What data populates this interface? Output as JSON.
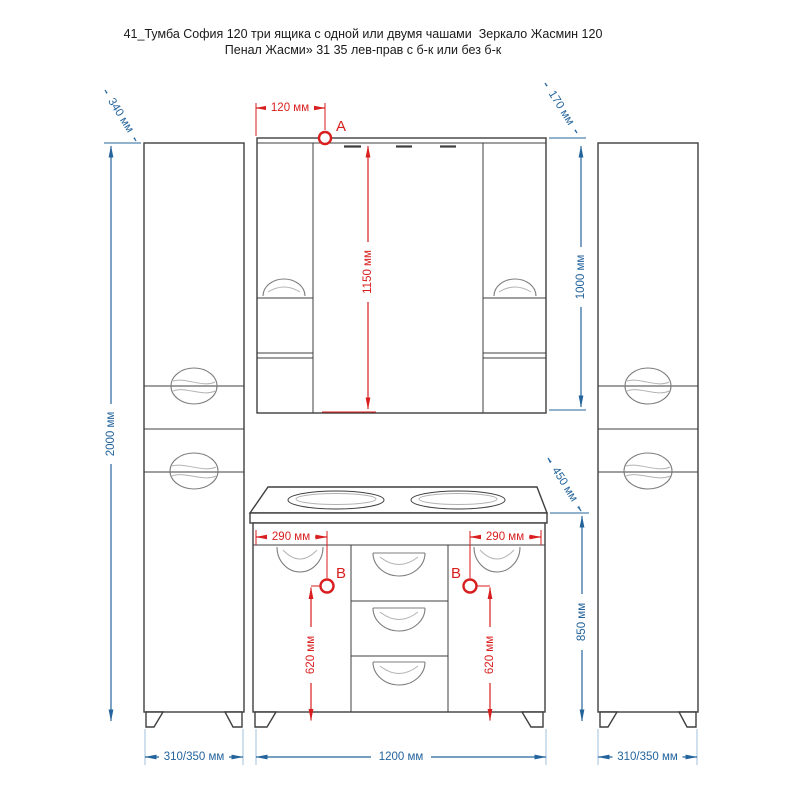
{
  "title": {
    "line1": "41_Тумба София 120 три ящика с одной или двумя чашами  Зеркало Жасмин 120",
    "line2": "Пенал Жасми» 31 35 лев-прав с б-к или без б-к"
  },
  "dimensions": {
    "cabinet_depth": "340 мм",
    "cabinet_height": "2000 мм",
    "point_a_offset": "120 мм",
    "mirror_shelf_depth": "170 мм",
    "mirror_mount_span": "1150 мм",
    "mirror_height": "1000 мм",
    "countertop_depth": "450 мм",
    "vanity_height": "850 мм",
    "left_sink_offset": "290 мм",
    "right_sink_offset": "290 мм",
    "left_point_b_height": "620 мм",
    "right_point_b_height": "620 мм",
    "left_cabinet_width": "310/350 мм",
    "vanity_width": "1200 мм",
    "right_cabinet_width": "310/350 мм"
  },
  "markers": {
    "point_a": "A",
    "point_b_left": "B",
    "point_b_right": "B"
  },
  "colors": {
    "dimension_blue": "#24649c",
    "dimension_red": "#d81e1e",
    "outline": "#3f3f3f",
    "extension_light_blue": "#a9c7e0",
    "text_black": "#1a1a1a"
  }
}
